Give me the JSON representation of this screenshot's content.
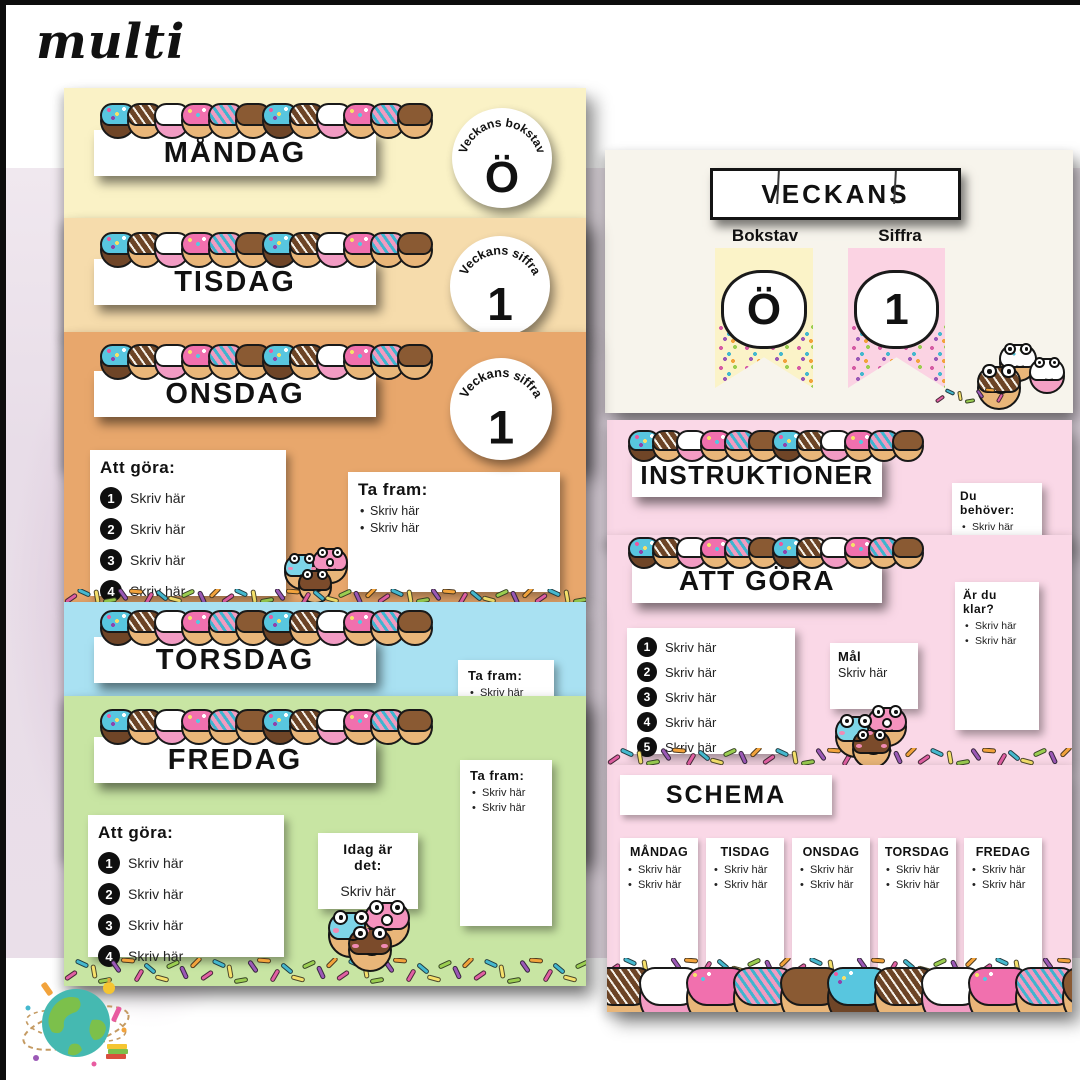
{
  "logo": {
    "text": "multi"
  },
  "ui": {
    "placeholder": "Skriv här"
  },
  "colors": {
    "monday_bg": "#FAF2C6",
    "tuesday_bg": "#F6DCAC",
    "wednesday_bg": "#E8A76C",
    "thursday_bg": "#A9E1F2",
    "friday_bg": "#C8E5A3",
    "pink_bg": "#FAD8E7",
    "cream_bg": "#F7F4EC",
    "lavender_bg": "#E8DDE8",
    "badge_circle": "#FFFFFF",
    "sprinkles": [
      "#E160A3",
      "#45B8CE",
      "#F5E06B",
      "#9BCE51",
      "#9B59B6",
      "#F2A33C"
    ]
  },
  "decor": {
    "donut_variants": [
      "blue-sprinkle",
      "chocolate-drizzle",
      "white-pink",
      "pink-sprinkle",
      "pink-teal-stripe",
      "caramel"
    ]
  },
  "slides": {
    "monday": {
      "title": "MÅNDAG",
      "badge_label": "Veckans bokstav",
      "badge_value": "Ö"
    },
    "tuesday": {
      "title": "TISDAG",
      "badge_label": "Veckans siffra",
      "badge_value": "1"
    },
    "wednesday": {
      "title": "ONSDAG",
      "badge_label": "Veckans siffra",
      "badge_value": "1",
      "todo_heading": "Att göra:",
      "todo_items": [
        {
          "n": "1",
          "t": "Skriv här"
        },
        {
          "n": "2",
          "t": "Skriv här"
        },
        {
          "n": "3",
          "t": "Skriv här"
        },
        {
          "n": "4",
          "t": "Skriv här"
        }
      ],
      "bring_heading": "Ta fram:",
      "bring_items": [
        "Skriv här",
        "Skriv här"
      ]
    },
    "thursday": {
      "title": "TORSDAG",
      "bring_heading": "Ta fram:",
      "bring_items": [
        "Skriv här"
      ]
    },
    "friday": {
      "title": "FREDAG",
      "todo_heading": "Att göra:",
      "todo_items": [
        {
          "n": "1",
          "t": "Skriv här"
        },
        {
          "n": "2",
          "t": "Skriv här"
        },
        {
          "n": "3",
          "t": "Skriv här"
        },
        {
          "n": "4",
          "t": "Skriv här"
        }
      ],
      "today_heading": "Idag är det:",
      "today_value": "Skriv här",
      "bring_heading": "Ta fram:",
      "bring_items": [
        "Skriv här",
        "Skriv här"
      ]
    },
    "veckans": {
      "title": "VECKANS",
      "letter_label": "Bokstav",
      "letter_value": "Ö",
      "number_label": "Siffra",
      "number_value": "1"
    },
    "instructions": {
      "title": "INSTRUKTIONER",
      "need_heading": "Du behöver:",
      "need_items": [
        "Skriv här",
        "Skriv här"
      ]
    },
    "att_gora": {
      "title": "ATT GÖRA",
      "todo_items": [
        {
          "n": "1",
          "t": "Skriv här"
        },
        {
          "n": "2",
          "t": "Skriv här"
        },
        {
          "n": "3",
          "t": "Skriv här"
        },
        {
          "n": "4",
          "t": "Skriv här"
        },
        {
          "n": "5",
          "t": "Skriv här"
        }
      ],
      "goal_heading": "Mål",
      "goal_value": "Skriv här",
      "done_heading": "Är du klar?",
      "done_items": [
        "Skriv här",
        "Skriv här"
      ]
    },
    "schema": {
      "title": "SCHEMA",
      "columns": [
        {
          "label": "MÅNDAG",
          "i1": "Skriv här",
          "i2": "Skriv här"
        },
        {
          "label": "TISDAG",
          "i1": "Skriv här",
          "i2": "Skriv här"
        },
        {
          "label": "ONSDAG",
          "i1": "Skriv här",
          "i2": "Skriv här"
        },
        {
          "label": "TORSDAG",
          "i1": "Skriv här",
          "i2": "Skriv här"
        },
        {
          "label": "FREDAG",
          "i1": "Skriv här",
          "i2": "Skriv här"
        }
      ]
    }
  }
}
